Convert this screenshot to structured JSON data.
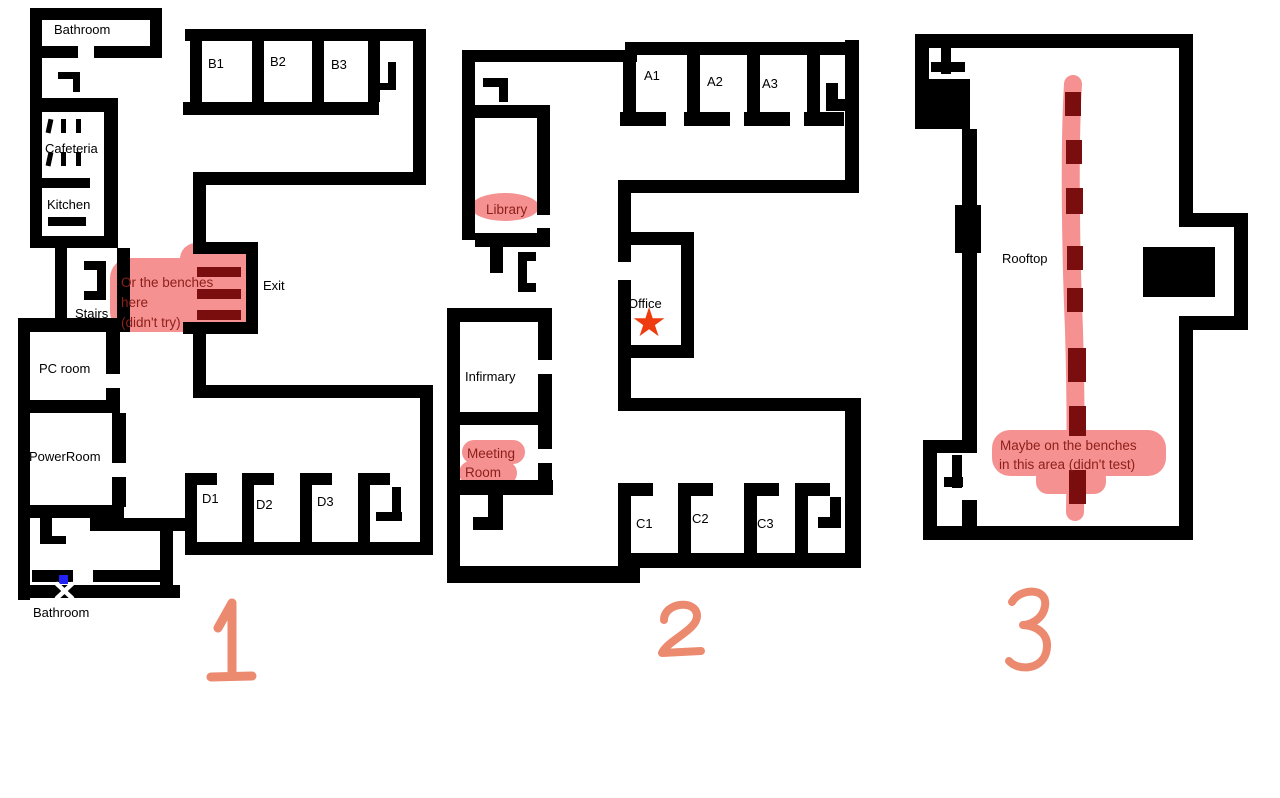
{
  "title": "Building floor plans with bench annotations",
  "floor1": {
    "number": "1",
    "labels": {
      "bathroom_top": "Bathroom",
      "b1": "B1",
      "b2": "B2",
      "b3": "B3",
      "cafeteria": "Cafeteria",
      "kitchen": "Kitchen",
      "stairs": "Stairs",
      "exit": "Exit",
      "pc_room": "PC room",
      "power_room": "PowerRoom",
      "d1": "D1",
      "d2": "D2",
      "d3": "D3",
      "bathroom_bottom": "Bathroom"
    },
    "annotation": {
      "line1": "Or the benches",
      "line2": "here",
      "line3": "(didn't try)"
    },
    "benches_count": 3
  },
  "floor2": {
    "number": "2",
    "labels": {
      "a1": "A1",
      "a2": "A2",
      "a3": "A3",
      "library": "Library",
      "office": "Office",
      "infirmary": "Infirmary",
      "meeting_line1": "Meeting",
      "meeting_line2": "Room",
      "c1": "C1",
      "c2": "C2",
      "c3": "C3"
    },
    "office_star": "star marking a spot in the Office"
  },
  "floor3": {
    "number": "3",
    "labels": {
      "rooftop": "Rooftop"
    },
    "annotation": {
      "line1": "Maybe on the benches",
      "line2": "in this area (didn't test)"
    },
    "benches_count": 8
  },
  "colors": {
    "wall": "#000000",
    "highlight_pink": "#f59190",
    "bench_maroon": "#7a0d0d",
    "annotation_text": "#8c1f1a",
    "number_salmon": "#ec8a70",
    "star_orange": "#ee3c10",
    "marker_blue": "#2222f5"
  }
}
